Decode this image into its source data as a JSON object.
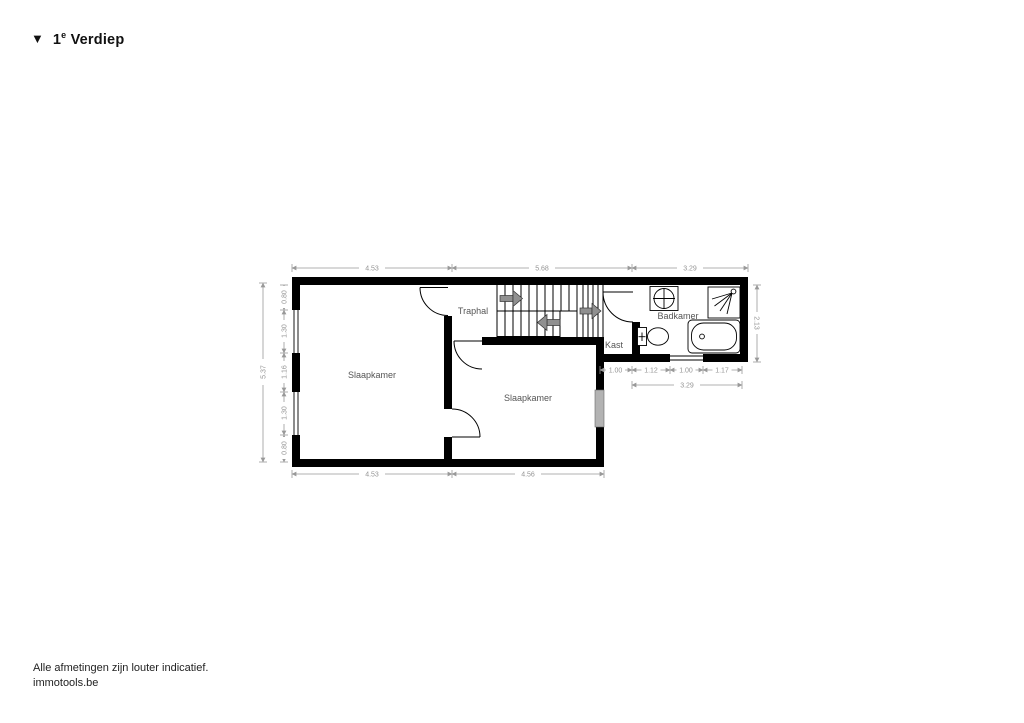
{
  "title": {
    "marker": "▼",
    "prefix": "1",
    "sup": "e",
    "name": "Verdiep"
  },
  "footer": {
    "line1": "Alle afmetingen zijn louter indicatief.",
    "line2": "immotools.be"
  },
  "rooms": {
    "bedroom_left": "Slaapkamer",
    "bedroom_mid": "Slaapkamer",
    "stair_hall": "Traphal",
    "closet": "Kast",
    "bathroom": "Badkamer"
  },
  "dimensions": {
    "top": [
      "4.53",
      "5.68",
      "3.29"
    ],
    "bottom": [
      "4.53",
      "4.56"
    ],
    "left_total": "5.37",
    "left_segments": [
      "0.80",
      "1.30",
      "1.16",
      "1.30",
      "0.80"
    ],
    "right": "2.13",
    "bath_segments": [
      "1.00",
      "1.12",
      "1.00",
      "1.17"
    ],
    "bath_total": "3.29"
  },
  "colors": {
    "wall": "#000000",
    "dimension_line": "#999999",
    "dimension_text": "#949494",
    "stair_arrow": "#909090",
    "window_glass": "#b3b3b3",
    "background": "#ffffff"
  }
}
